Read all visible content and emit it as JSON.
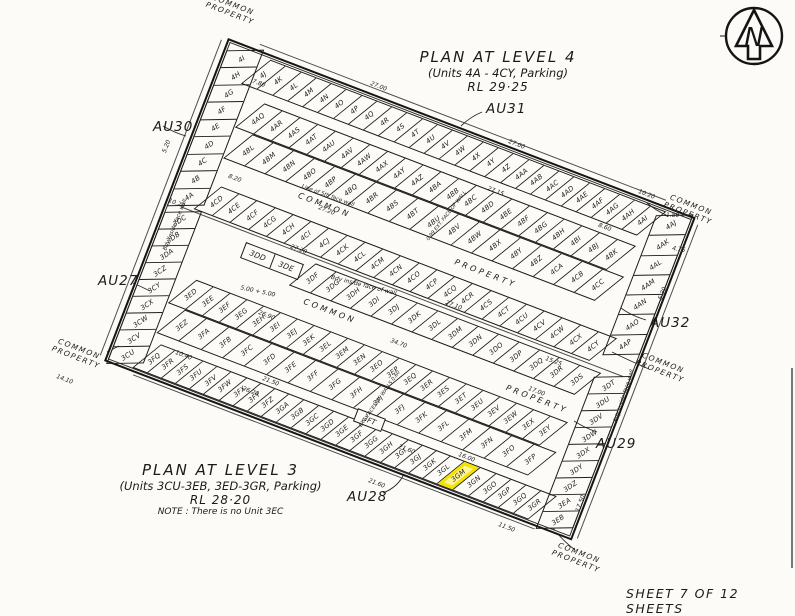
{
  "page": {
    "sheet_label": "SHEET 7 OF 12 SHEETS",
    "background": "#fcfbf7",
    "ink": "#1b1b1b"
  },
  "north_arrow": {
    "label": "N"
  },
  "titles": {
    "level4": {
      "line1": "PLAN AT LEVEL 4",
      "line2": "(Units 4A - 4CY, Parking)",
      "line3": "RL 29·25"
    },
    "level3": {
      "line1": "PLAN AT LEVEL 3",
      "line2": "(Units 3CU-3EB, 3ED-3GR, Parking)",
      "line3": "RL 28·20",
      "note": "NOTE : There is no Unit 3EC"
    }
  },
  "external_labels": {
    "au30": "AU30",
    "au31": "AU31",
    "au27": "AU27",
    "au32": "AU32",
    "au29": "AU29",
    "au28": "AU28"
  },
  "common_property": {
    "line1": "COMMON",
    "line2": "PROPERTY"
  },
  "highlight": {
    "unit": "3GM",
    "color": "#f4e300"
  },
  "plan": {
    "boxed_unit": "3FT",
    "driveway_words": [
      "COMMON",
      "PROPERTY"
    ],
    "rows": {
      "l4_left": {
        "labels": [
          "4I",
          "4H",
          "4G",
          "4F",
          "4E",
          "4D",
          "4C",
          "4B",
          "4A"
        ]
      },
      "l4_top": {
        "labels": [
          "4J",
          "4K",
          "4L",
          "4M",
          "4N",
          "4O",
          "4P",
          "4Q",
          "4R",
          "4S",
          "4T",
          "4U",
          "4V",
          "4W",
          "4X",
          "4Y",
          "4Z",
          "4AA",
          "4AB",
          "4AC",
          "4AD",
          "4AE",
          "4AF",
          "4AG",
          "4AH",
          "4AI"
        ]
      },
      "l4_right": {
        "labels": [
          "4AJ",
          "4AK",
          "4AL",
          "4AM",
          "4AN",
          "4AO",
          "4AP"
        ]
      },
      "l4_inner_a": {
        "labels": [
          "4AQ",
          "4AR",
          "4AS",
          "4AT",
          "4AU",
          "4AV",
          "4AW",
          "4AX",
          "4AY",
          "4AZ",
          "4BA",
          "4BB",
          "4BC",
          "4BD",
          "4BE",
          "4BF",
          "4BG",
          "4BH",
          "4BI",
          "4BJ",
          "4BK"
        ]
      },
      "l4_inner_b": {
        "labels": [
          "4BL",
          "4BM",
          "4BN",
          "4BO",
          "4BP",
          "4BQ",
          "4BR",
          "4BS",
          "4BT",
          "4BU",
          "4BV",
          "4BW",
          "4BX",
          "4BY",
          "4BZ",
          "4CA",
          "4CB",
          "4CC"
        ]
      },
      "l4_bottom": {
        "labels": [
          "4CD",
          "4CE",
          "4CF",
          "4CG",
          "4CH",
          "4CI",
          "4CJ",
          "4CK",
          "4CL",
          "4CM",
          "4CN",
          "4CO",
          "4CP",
          "4CQ",
          "4CR",
          "4CS",
          "4CT",
          "4CU",
          "4CV",
          "4CW",
          "4CX",
          "4CY"
        ]
      },
      "l3_left": {
        "labels": [
          "3DC",
          "3DB",
          "3DA",
          "3CZ",
          "3CY",
          "3CX",
          "3CW",
          "3CV",
          "3CU"
        ]
      },
      "l3_pair": {
        "labels": [
          "3DD",
          "3DE"
        ]
      },
      "l3_mid": {
        "labels": [
          "3DF",
          "3DG",
          "3DH",
          "3DI",
          "3DJ",
          "3DK",
          "3DL",
          "3DM",
          "3DN",
          "3DO",
          "3DP",
          "3DQ",
          "3DR",
          "3DS"
        ]
      },
      "l3_right": {
        "labels": [
          "3DT",
          "3DU",
          "3DV",
          "3DW",
          "3DX",
          "3DY",
          "3DZ",
          "3EA",
          "3EB"
        ]
      },
      "l3_inner_a": {
        "labels": [
          "3ED",
          "3EE",
          "3EF",
          "3EG",
          "3EH",
          "3EI",
          "3EJ",
          "3EK",
          "3EL",
          "3EM",
          "3EN",
          "3EO",
          "3EP",
          "3EQ",
          "3ER",
          "3ES",
          "3ET",
          "3EU",
          "3EV",
          "3EW",
          "3EX",
          "3EY"
        ]
      },
      "l3_inner_b": {
        "labels": [
          "3EZ",
          "3FA",
          "3FB",
          "3FC",
          "3FD",
          "3FE",
          "3FF",
          "3FG",
          "3FH",
          "3FI",
          "3FJ",
          "3FK",
          "3FL",
          "3FM",
          "3FN",
          "3FO",
          "3FP"
        ]
      },
      "l3_bottom": {
        "labels": [
          "3FQ",
          "3FR",
          "3FS",
          "3FU",
          "3FV",
          "3FW",
          "3FX",
          "3FY",
          "3FZ",
          "3GA",
          "3GB",
          "3GC",
          "3GD",
          "3GE",
          "3GF",
          "3GG",
          "3GH",
          "3GI",
          "3GJ",
          "3GK",
          "3GL",
          "3GM",
          "3GN",
          "3GO",
          "3GP",
          "3GQ",
          "3GR"
        ]
      }
    }
  },
  "dimensions": [
    {
      "label": "7.80",
      "x": 252,
      "y": 80
    },
    {
      "label": "27.00",
      "x": 370,
      "y": 83
    },
    {
      "label": "27.00",
      "x": 508,
      "y": 141
    },
    {
      "label": "27.15",
      "x": 487,
      "y": 188
    },
    {
      "label": "8.20",
      "x": 228,
      "y": 175
    },
    {
      "label": "10.20",
      "x": 168,
      "y": 200
    },
    {
      "label": "5.20",
      "x": 160,
      "y": 143,
      "r": -70
    },
    {
      "label": "8.60",
      "x": 598,
      "y": 224
    },
    {
      "label": "1.80",
      "x": 666,
      "y": 212,
      "r": 0
    },
    {
      "label": "4.75",
      "x": 672,
      "y": 246,
      "r": 10
    },
    {
      "label": "10.20",
      "x": 638,
      "y": 191
    },
    {
      "label": "5.30",
      "x": 656,
      "y": 290,
      "r": -70
    },
    {
      "label": "27.20",
      "x": 318,
      "y": 207
    },
    {
      "label": "27.20",
      "x": 290,
      "y": 246
    },
    {
      "label": "27.10",
      "x": 445,
      "y": 302
    },
    {
      "label": "34.70",
      "x": 390,
      "y": 340
    },
    {
      "label": "26.90",
      "x": 258,
      "y": 312
    },
    {
      "label": "5.00 + 5.00",
      "x": 240,
      "y": 288,
      "r": 12
    },
    {
      "label": "21.50",
      "x": 262,
      "y": 378
    },
    {
      "label": "26.20",
      "x": 242,
      "y": 388
    },
    {
      "label": "21.60",
      "x": 398,
      "y": 446
    },
    {
      "label": "16.00",
      "x": 458,
      "y": 454
    },
    {
      "label": "21.60",
      "x": 368,
      "y": 480
    },
    {
      "label": "11.50",
      "x": 498,
      "y": 524
    },
    {
      "label": "17.50",
      "x": 572,
      "y": 500,
      "r": -70
    },
    {
      "label": "14.10",
      "x": 56,
      "y": 376
    },
    {
      "label": "10.40",
      "x": 175,
      "y": 352
    },
    {
      "label": "15.25",
      "x": 545,
      "y": 358
    },
    {
      "label": "17.00",
      "x": 528,
      "y": 388
    }
  ],
  "annotations": [
    {
      "text": "Bdy inside face wall",
      "x": 148,
      "y": 222,
      "r": -68
    },
    {
      "text": "Bdy  inside  face  of  wall",
      "x": 330,
      "y": 282,
      "r": 14,
      "fs": 6
    },
    {
      "text": "Bdy inside face wall",
      "x": 597,
      "y": 393,
      "r": -72
    },
    {
      "text": "Line of 5th face wall",
      "x": 300,
      "y": 193,
      "r": 20
    },
    {
      "text": "0.99 EXT. FACE OF WALL",
      "x": 416,
      "y": 213,
      "r": -52,
      "fs": 5
    },
    {
      "text": "EXT. FACES OF WALLS 0.60",
      "x": 346,
      "y": 396,
      "r": -55,
      "fs": 5
    }
  ]
}
